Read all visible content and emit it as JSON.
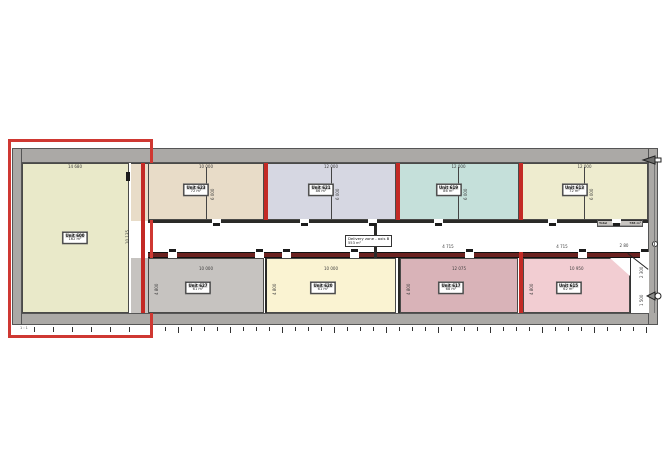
{
  "drawing": {
    "title": "warehouse-unit-floor-plan",
    "colors": {
      "highlight": "#cf3832",
      "fire_wall": "#c32a25",
      "corridor_wall": "#6b2220",
      "outer_wall": "#aba9a6",
      "black_wall": "#2a2a28"
    },
    "left_unit": {
      "label": "Unit 600",
      "area": "162 m²",
      "dim_top": "14 680",
      "dim_side": "10 135",
      "color": "#e9e9c9"
    },
    "top_units": [
      {
        "label": "Unit 623",
        "area": "72 m²",
        "dim_top": "10 000",
        "dim_side": "6 000",
        "color": "#e8dcc8"
      },
      {
        "label": "Unit 621",
        "area": "86 m²",
        "dim_top": "12 000",
        "dim_side": "6 000",
        "color": "#d6d7e2"
      },
      {
        "label": "Unit 619",
        "area": "86 m²",
        "dim_top": "12 000",
        "dim_side": "6 000",
        "color": "#c5e0da"
      },
      {
        "label": "Unit 613",
        "area": "72 m²",
        "dim_top": "12 000",
        "dim_side": "6 000",
        "color": "#eeeccf"
      }
    ],
    "bottom_units": [
      {
        "label": "Unit 627",
        "area": "61 m²",
        "dim_top": "10 000",
        "dim_side": "4 800",
        "color": "#c6c3c0"
      },
      {
        "label": "Unit 620",
        "area": "61 m²",
        "dim_top": "10 000",
        "dim_side": "4 800",
        "color": "#faf3d2"
      },
      {
        "label": "Unit 617",
        "area": "68 m²",
        "dim_top": "12 075",
        "dim_side": "4 800",
        "color": "#d9b3b8"
      },
      {
        "label": "Unit 615",
        "area": "62 m²",
        "dim_top": "10 950",
        "dim_side": "4 800",
        "color": "#f2cdd2"
      }
    ],
    "corridor": {
      "label": "Delivery zone - axis B",
      "area": "553 m²",
      "dims": [
        "4 715",
        "4 715",
        "2 80"
      ]
    },
    "right_dims": [
      "2 300",
      "1 500"
    ],
    "scale_note": "1 : 1",
    "legend": {
      "rows": [
        [
          "Unit 613",
          "72 m²"
        ],
        [
          "Unit 615",
          "62 m²"
        ],
        [
          "Unit 617",
          "68 m²"
        ],
        [
          "Unit 619",
          "86 m²"
        ],
        [
          "Unit 620",
          "61 m²"
        ],
        [
          "Unit 621",
          "86 m²"
        ],
        [
          "Unit 623",
          "72 m²"
        ],
        [
          "Unit 625",
          "58 m²"
        ],
        [
          "Unit 627",
          "61 m²"
        ],
        [
          "Unit 600",
          "162 m²"
        ]
      ],
      "total_label": "Total",
      "total_value": "788 m²"
    }
  }
}
